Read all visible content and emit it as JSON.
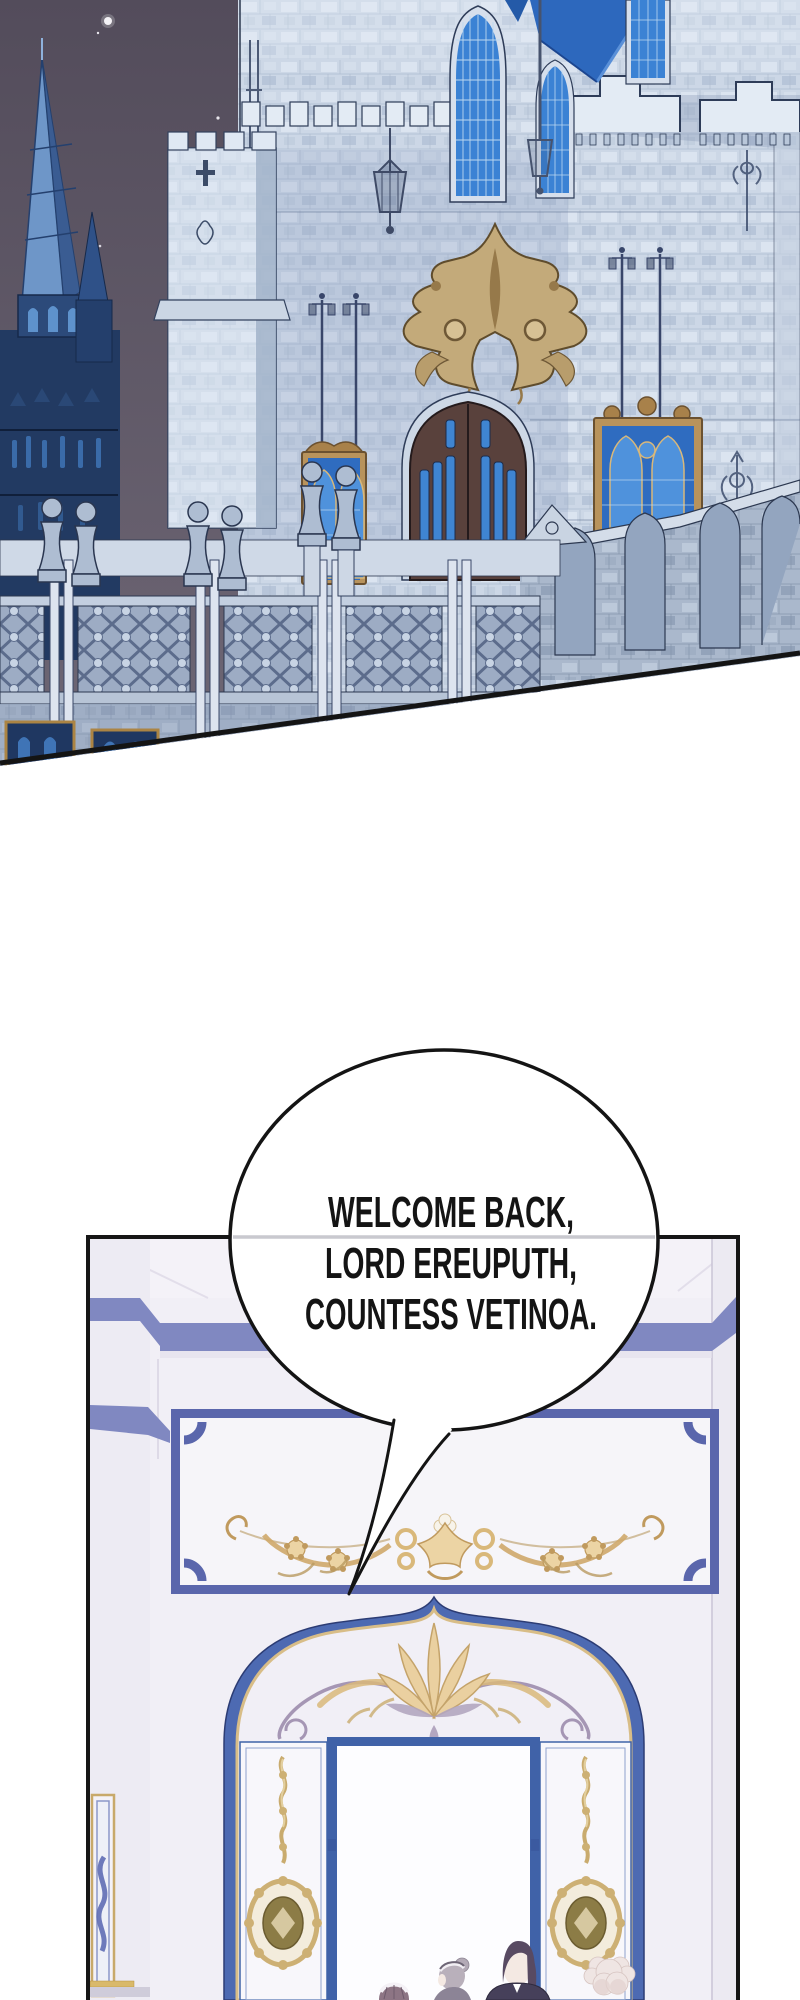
{
  "page": {
    "width": 800,
    "height": 2000,
    "background": "#ffffff",
    "kind": "webtoon comic page segment"
  },
  "panels": [
    {
      "id": "castle-exterior-night",
      "description": "Night exterior of a grey-blue gothic castle: dark starry sky, blue spired church at left, crenellated stone tower, large stone facade with blue stained-glass lancet windows, bright blue roof, gold crest above a brown pointed double door, hanging lanterns, lamp posts and a stone balustrade terrace; panel bottom edge is a diagonal cut"
    },
    {
      "id": "palace-interior-entrance",
      "description": "Bright white and blue palace hall: blue cornice stripes, blue-framed plaque with gold floral frieze, grand blue pointed archway with gilded palmette ornament, two opened white doors carved with gold scrolls and medallions, servants standing at the bright doorway"
    }
  ],
  "speech_bubble": {
    "shape": "ellipse with thin tail pointing down-left",
    "fill": "#ffffff",
    "stroke": "#141414",
    "lines": [
      "WELCOME BACK,",
      "LORD EREUPUTH,",
      "COUNTESS VETINOA."
    ]
  },
  "colors": {
    "night_sky": "#5a5362",
    "castle_stone": "#ccd7e6",
    "castle_outline": "#2c3850",
    "spire_blue": "#6e96c8",
    "window_glass_blue": "#3b82d4",
    "roof_blue": "#2d68bd",
    "crest_gold": "#c3aa7a",
    "door_brown": "#59413c",
    "interior_wall": "#f1eff6",
    "interior_blue": "#5a66ac",
    "arch_blue": "#4d6ab2",
    "ornament_gold": "#ecd4a4",
    "panel_border": "#161616",
    "butler_hair": "#584a62",
    "maid_hair_grey": "#b9b0bb",
    "maid_hair_mauve": "#8d7584",
    "fluffy_hair_pink": "#efe5e3"
  }
}
